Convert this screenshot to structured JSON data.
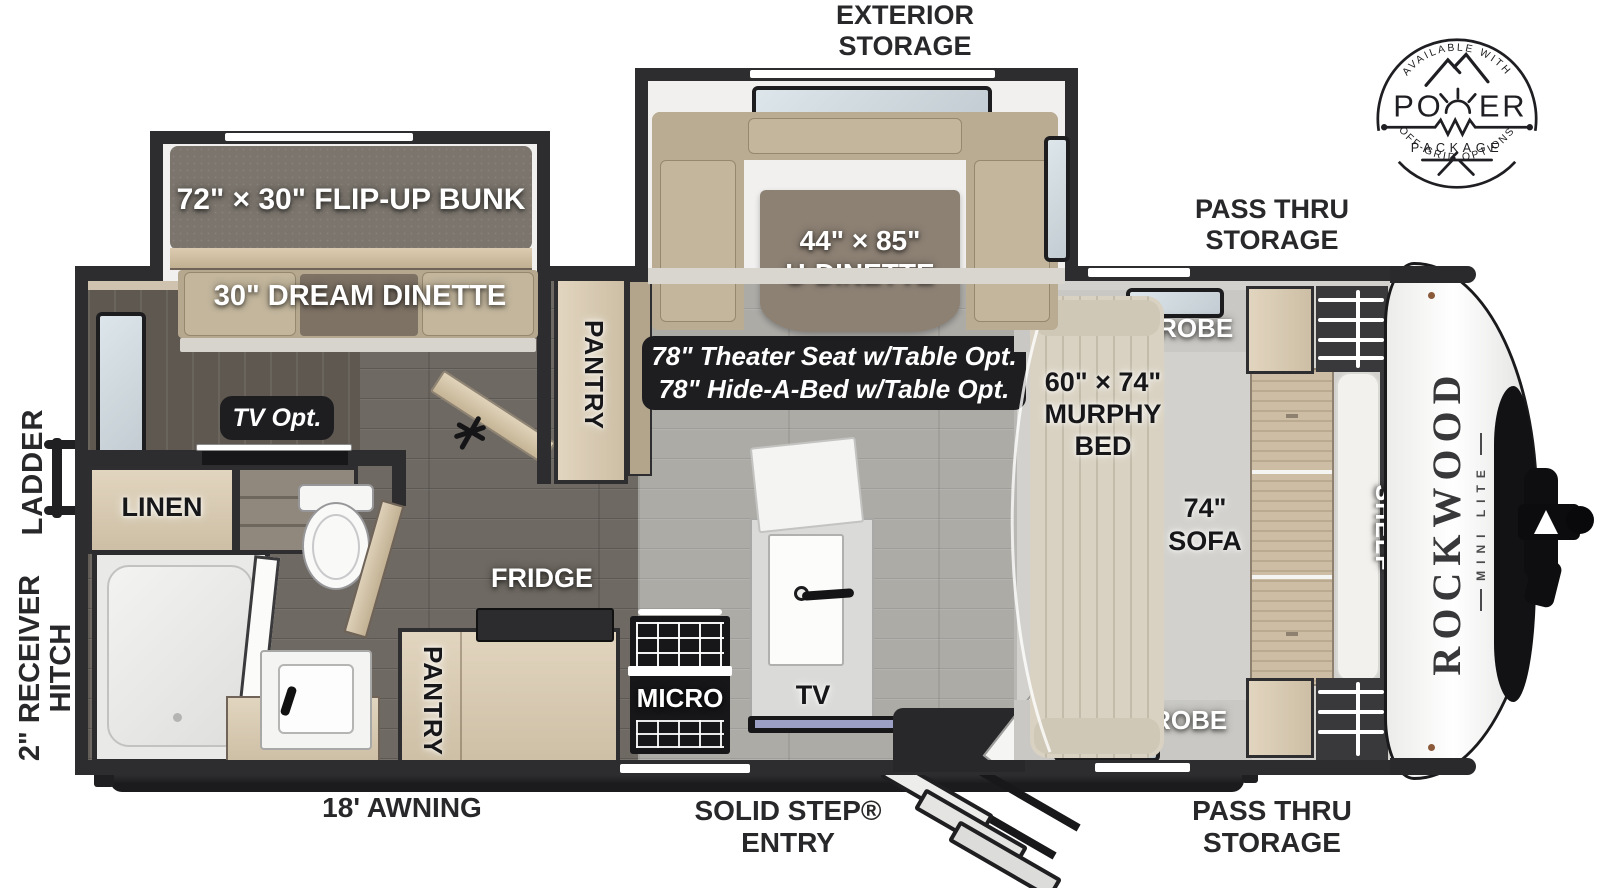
{
  "exterior": {
    "exterior_storage": {
      "line1": "EXTERIOR",
      "line2": "STORAGE"
    },
    "pass_thru_top": {
      "line1": "PASS THRU",
      "line2": "STORAGE"
    },
    "pass_thru_bottom": {
      "line1": "PASS THRU",
      "line2": "STORAGE"
    },
    "awning": "18' AWNING",
    "solid_step": {
      "line1": "SOLID STEP®",
      "line2": "ENTRY"
    },
    "ladder": "LADDER",
    "receiver_hitch": {
      "line1": "2\" RECEIVER",
      "line2": "HITCH"
    }
  },
  "badge": {
    "top_arc": "AVAILABLE WITH",
    "word_left": "PO",
    "word_right": "ER",
    "package": "PACKAGE",
    "bottom_arc": "OFF-GRID OPTIONS"
  },
  "rooms": {
    "flip_up_bunk": "72\" × 30\" FLIP-UP BUNK",
    "dream_dinette": "30\" DREAM DINETTE",
    "u_dinette": {
      "line1": "44\" × 85\"",
      "line2": "U-DINETTE"
    },
    "theater": {
      "line1": "78\" Theater Seat w/Table Opt.",
      "line2": "78\" Hide-A-Bed w/Table Opt."
    },
    "tv_opt": "TV Opt.",
    "linen": "LINEN",
    "pantry_upper": "PANTRY",
    "pantry_lower": "PANTRY",
    "fridge": "FRIDGE",
    "micro": "MICRO",
    "tv": "TV",
    "wardrobe_top": "WARDROBE",
    "wardrobe_bottom": "WARDROBE",
    "murphy_bed": {
      "line1": "60\" × 74\"",
      "line2": "MURPHY",
      "line3": "BED"
    },
    "sofa": {
      "line1": "74\"",
      "line2": "SOFA"
    },
    "shelf": "SHELF"
  },
  "brand": {
    "name": "ROCKWOOD",
    "sub": "MINI LITE"
  },
  "colors": {
    "wall": "#2d2d2f",
    "wood": "#d8cbb3",
    "floor_dark": "#6e6962",
    "floor_light": "#adaba6",
    "label_pill": "#1e1e21"
  }
}
